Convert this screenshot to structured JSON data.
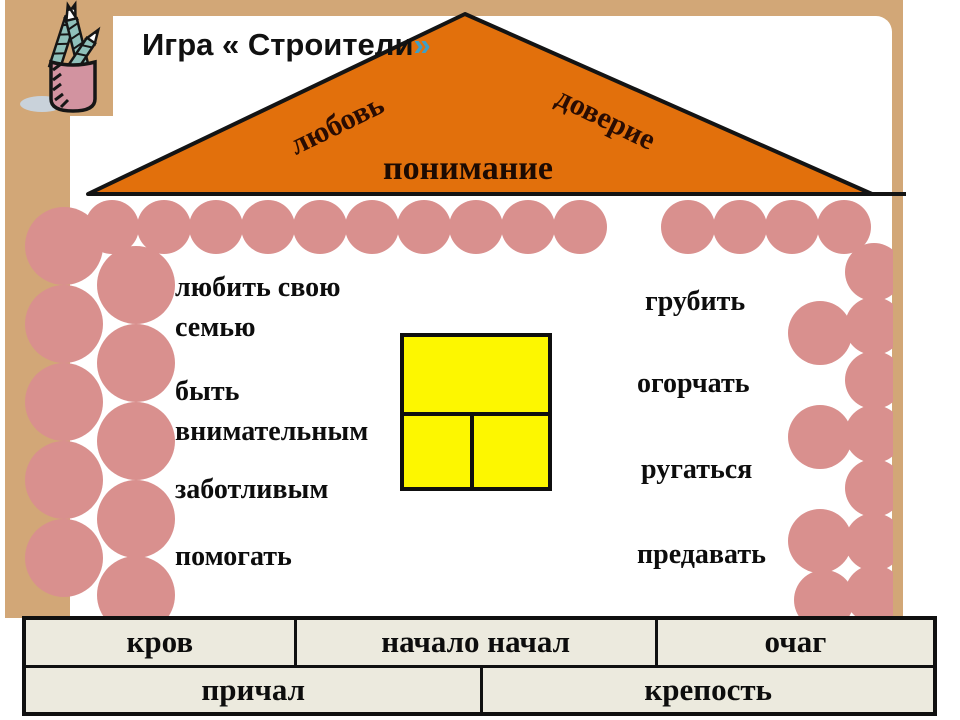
{
  "title": {
    "main": "Игра « Строители",
    "closing_quote": "»"
  },
  "roof_labels": {
    "left": "любовь",
    "right": "доверие",
    "center": "понимание"
  },
  "inside_words": [
    "любить свою\nсемью",
    "быть\nвнимательным",
    "заботливым",
    "помогать"
  ],
  "outside_words": [
    "грубить",
    "огорчать",
    "ругаться",
    "предавать"
  ],
  "house_table": {
    "row1": [
      "кров",
      "начало начал",
      "очаг"
    ],
    "row2": [
      "причал",
      "крепость"
    ]
  },
  "colors": {
    "frame": "#d2a777",
    "brick": "#d9908e",
    "roof": "#e2700c",
    "window": "#fdf700",
    "table_bg": "#eceade",
    "quote_accent": "#3f9fc6"
  }
}
